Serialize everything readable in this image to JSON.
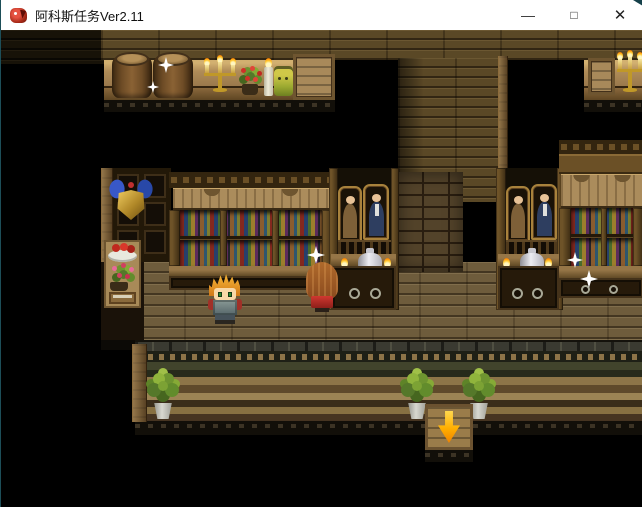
{
  "window": {
    "title": "阿科斯任务Ver2.11",
    "controls": {
      "minimize": "—",
      "maximize": "□",
      "close": "✕"
    }
  },
  "game": {
    "exit_arrow": {
      "glyph": "↓",
      "direction": "down",
      "color": "#ffae00"
    },
    "colors": {
      "background": "#000000",
      "titlebar": "#ffffff",
      "wood_wall": "#5a4826",
      "floor": "#6e5c3c",
      "shelf_surface": "#b08c58",
      "brick_wall": "#53432a",
      "sparkle": "#ffffff",
      "hero_hair": "#f0a028",
      "npc_hair": "#9a5a28",
      "npc_dress": "#c23028",
      "plant_leaves": "#7ca234"
    },
    "scene_objects": [
      "barrels-on-shelf",
      "candelabra",
      "red-flower-pot",
      "white-candle",
      "yellow-jar",
      "wooden-crate",
      "shield-wall-ornament",
      "fruit-plate",
      "pink-flower-pot",
      "book",
      "bookshelf-left",
      "bookshelf-right",
      "portrait-paintings",
      "amphora-vase",
      "cabinet-with-ring-handles",
      "brick-wall",
      "door-post",
      "hero-character",
      "npc-girl",
      "sparkles",
      "potted-plants",
      "stone-platform",
      "exit-arrow-indicator"
    ]
  }
}
